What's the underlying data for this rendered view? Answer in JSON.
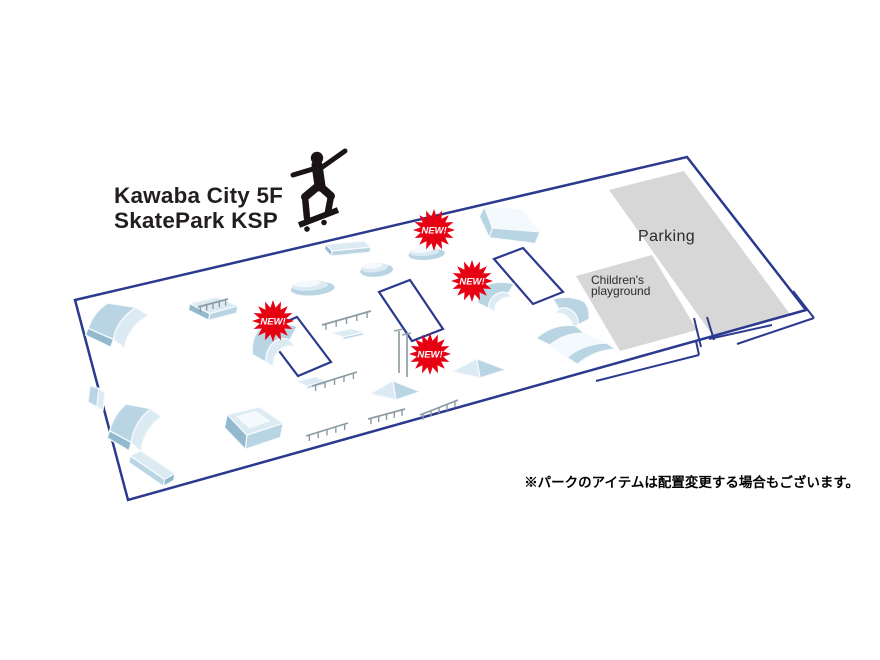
{
  "title": {
    "line1": "Kawaba City 5F",
    "line2": "SkatePark KSP"
  },
  "note": "※パークのアイテムは配置変更する場合もございます。",
  "colors": {
    "boundary": "#2b3a8f",
    "zone_gray": "#d7d7d7",
    "badge_red": "#e60012",
    "rail_gray": "#8b9ba4",
    "obstacle_hi": "#f3f9fc",
    "obstacle_light": "#dcebf3",
    "obstacle_mid": "#b9d5e3",
    "obstacle_dark": "#92b9cd"
  },
  "zones": [
    {
      "name": "parking",
      "label": "Parking",
      "points": [
        [
          609,
          190
        ],
        [
          684,
          171
        ],
        [
          790,
          314
        ],
        [
          713,
          336
        ]
      ]
    },
    {
      "name": "childrens-playground",
      "label_line1": "Children's",
      "label_line2": "playground",
      "points": [
        [
          576,
          276
        ],
        [
          652,
          255
        ],
        [
          697,
          330
        ],
        [
          620,
          351
        ]
      ]
    }
  ],
  "park": {
    "boundary": [
      [
        75,
        300
      ],
      [
        687,
        157
      ],
      [
        806,
        310
      ],
      [
        128,
        500
      ]
    ],
    "flat_areas": [
      {
        "points": [
          [
            297,
            317
          ],
          [
            331,
            362
          ],
          [
            298,
            376
          ],
          [
            264,
            331
          ]
        ]
      },
      {
        "points": [
          [
            410,
            280
          ],
          [
            443,
            329
          ],
          [
            412,
            341
          ],
          [
            379,
            292
          ]
        ]
      },
      {
        "points": [
          [
            523,
            248
          ],
          [
            563,
            292
          ],
          [
            533,
            304
          ],
          [
            494,
            259
          ]
        ]
      }
    ],
    "entrance_segments": [
      [
        596,
        381,
        699,
        355
      ],
      [
        699,
        355,
        696,
        341
      ],
      [
        709,
        339,
        772,
        325
      ],
      [
        694,
        318,
        701,
        347
      ],
      [
        707,
        317,
        714,
        340
      ],
      [
        737,
        344,
        814,
        318
      ],
      [
        814,
        318,
        793,
        291
      ]
    ],
    "obstacles": [
      {
        "name": "quarter-pipe",
        "type": "qp",
        "x": 84,
        "y": 302,
        "w": 70,
        "h": 55
      },
      {
        "name": "quarter-pipe",
        "type": "qp",
        "x": 106,
        "y": 403,
        "w": 60,
        "h": 58
      },
      {
        "name": "grind-box",
        "type": "box",
        "x": 126,
        "y": 450,
        "w": 52,
        "h": 42
      },
      {
        "name": "funbox",
        "type": "funbox",
        "x": 216,
        "y": 406,
        "w": 70,
        "h": 54
      },
      {
        "name": "table",
        "type": "tablerail",
        "x": 184,
        "y": 295,
        "w": 56,
        "h": 36
      },
      {
        "name": "manual-pad",
        "type": "flatbox",
        "x": 318,
        "y": 241,
        "w": 54,
        "h": 28
      },
      {
        "name": "roller",
        "type": "hump",
        "x": 358,
        "y": 256,
        "w": 36,
        "h": 24
      },
      {
        "name": "roller",
        "type": "hump",
        "x": 288,
        "y": 273,
        "w": 48,
        "h": 26
      },
      {
        "name": "roller",
        "type": "hump",
        "x": 406,
        "y": 241,
        "w": 40,
        "h": 22
      },
      {
        "name": "bank-ramp",
        "type": "wedgebig",
        "x": 463,
        "y": 206,
        "w": 82,
        "h": 48
      },
      {
        "name": "curved-ramp",
        "type": "curve",
        "x": 250,
        "y": 322,
        "w": 62,
        "h": 56
      },
      {
        "name": "curved-ramp",
        "type": "curve",
        "x": 476,
        "y": 281,
        "w": 50,
        "h": 38
      },
      {
        "name": "quarter-ramp",
        "type": "curve2",
        "x": 541,
        "y": 296,
        "w": 50,
        "h": 40
      },
      {
        "name": "mini-ramp",
        "type": "miniramp",
        "x": 531,
        "y": 321,
        "w": 86,
        "h": 48
      },
      {
        "name": "pyramid",
        "type": "pyramid",
        "x": 450,
        "y": 354,
        "w": 58,
        "h": 34
      },
      {
        "name": "kicker",
        "type": "pyramid",
        "x": 368,
        "y": 376,
        "w": 54,
        "h": 34
      },
      {
        "name": "small-ramp",
        "type": "smallwedge",
        "x": 86,
        "y": 383,
        "w": 34,
        "h": 34
      },
      {
        "name": "ledge",
        "type": "smallbox",
        "x": 293,
        "y": 376,
        "w": 36,
        "h": 20
      },
      {
        "name": "ledge",
        "type": "smallbox",
        "x": 328,
        "y": 328,
        "w": 38,
        "h": 18
      }
    ],
    "rails": [
      [
        322,
        325,
        371,
        311
      ],
      [
        312,
        386,
        357,
        372
      ],
      [
        306,
        436,
        348,
        423
      ],
      [
        368,
        419,
        405,
        409
      ],
      [
        420,
        415,
        458,
        400
      ],
      [
        198,
        307,
        228,
        299
      ]
    ],
    "gates": [
      [
        399,
        331,
        399,
        373
      ],
      [
        407,
        335,
        407,
        377
      ]
    ]
  },
  "badges": {
    "label": "NEW!",
    "items": [
      [
        434,
        230
      ],
      [
        472,
        281
      ],
      [
        273,
        321
      ],
      [
        430,
        354
      ]
    ]
  }
}
